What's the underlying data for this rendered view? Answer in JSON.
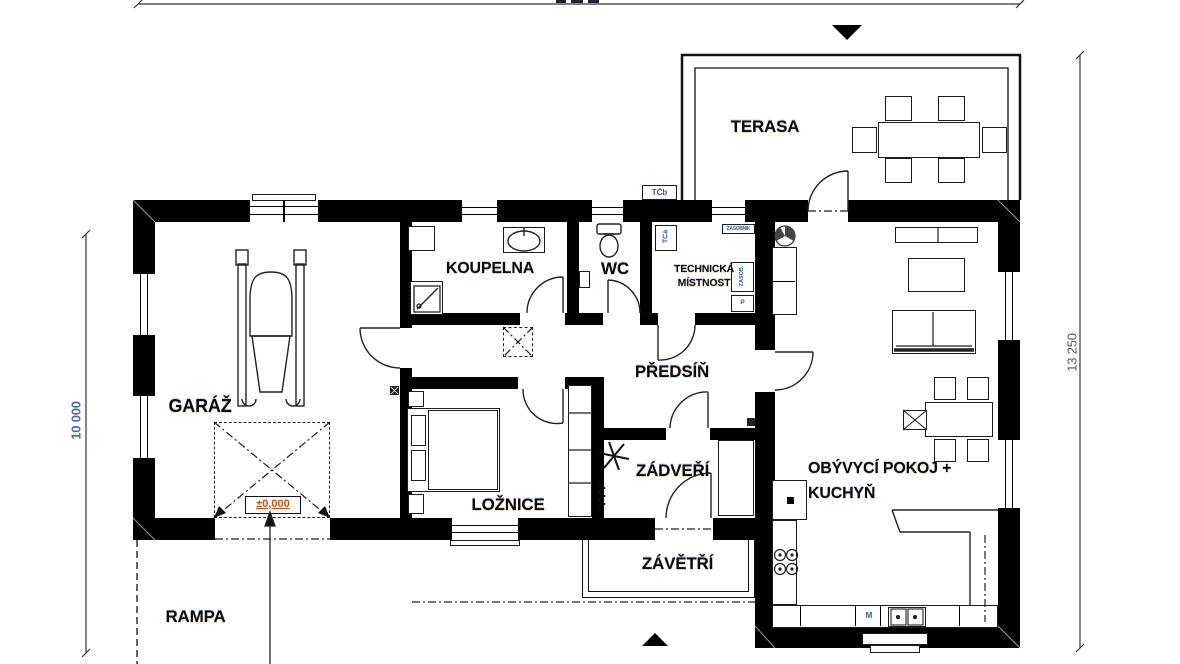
{
  "plan": {
    "title": "family-house floor plan",
    "rooms": {
      "garaz": "GARÁŽ",
      "koupelna": "KOUPELNA",
      "wc": "WC",
      "technicka_line1": "TECHNICKÁ",
      "technicka_line2": "MÍSTNOST",
      "predsin": "PŘEDSÍŇ",
      "loznice": "LOŽNICE",
      "zadveri": "ZÁDVEŘÍ",
      "zavetri": "ZÁVĚTŘÍ",
      "obyvaci_line1": "OBÝVYCÍ POKOJ +",
      "obyvaci_line2": "KUCHYŇ",
      "terasa": "TERASA",
      "rampa": "RAMPA"
    },
    "dimensions": {
      "left_vertical": "10 000",
      "right_vertical": "13 250"
    },
    "levels": {
      "zero": "±0,000"
    },
    "equipment": {
      "heat_pump_indoor": "TČa",
      "heat_pump_outdoor": "TČb",
      "tank": "ZÁSOBNÍK",
      "tank_vertical": "ZÁSOB.",
      "washer": "P",
      "dishwasher": "M"
    },
    "colors": {
      "wall": "#000000",
      "level_text": "#c0541a",
      "dim_text_left": "#4a6da7",
      "dim_text_right": "#555555",
      "equipment_text": "#2b59b5",
      "label_text": "#0b0b0b"
    }
  }
}
